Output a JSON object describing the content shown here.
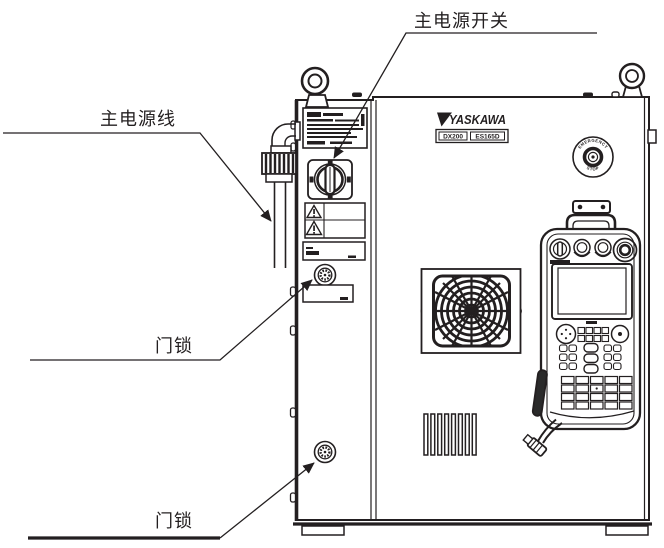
{
  "colors": {
    "ink": "#231f20",
    "background": "#ffffff"
  },
  "callouts": {
    "main_power_switch": {
      "label": "主电源开关"
    },
    "main_power_cable": {
      "label": "主电源线"
    },
    "door_lock_upper": {
      "label": "门锁"
    },
    "door_lock_lower": {
      "label": "门锁"
    }
  },
  "cabinet": {
    "logo_text": "YASKAWA",
    "model_plate": {
      "series": "DX200",
      "model": "ES165D"
    },
    "emergency_stop": {
      "arc_top": "EMERGENCY",
      "arc_bottom": "STOP"
    }
  }
}
